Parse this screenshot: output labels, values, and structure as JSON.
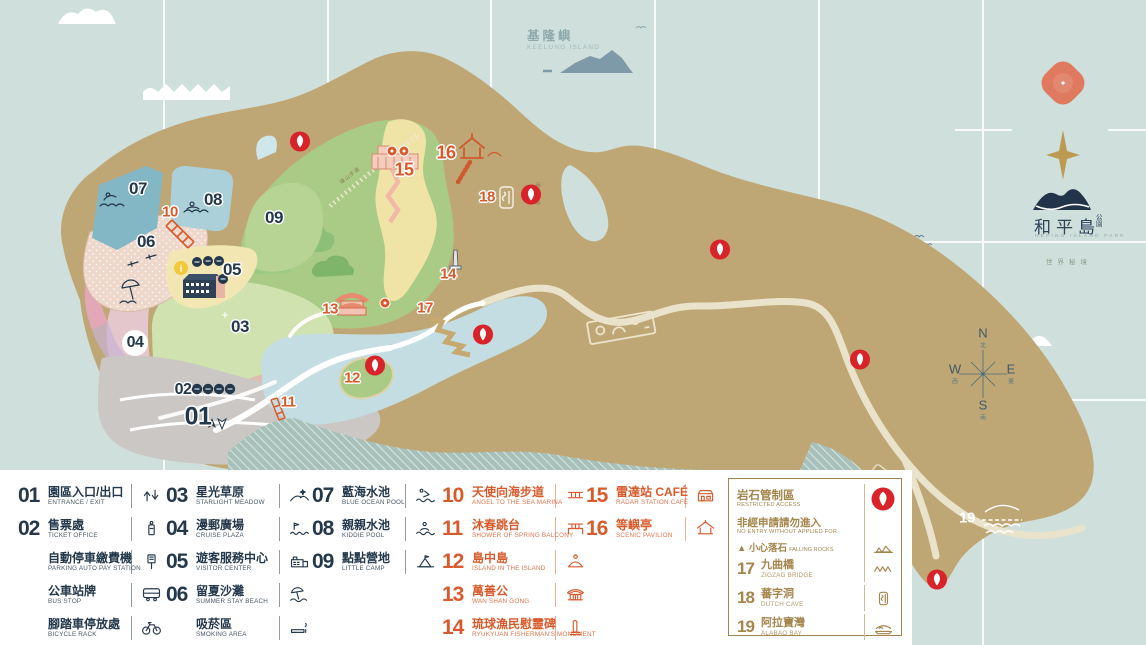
{
  "title": "和平島公園 Heping Island Park Map",
  "colors": {
    "navy": "#24384C",
    "orange": "#D95B2D",
    "gold": "#A5854C",
    "pin_red": "#D8232A",
    "sea": "#CFE0DC",
    "land": "#BFA775"
  },
  "map": {
    "keelung": {
      "cn": "基隆嶼",
      "en": "KEELUNG ISLAND"
    },
    "logo": {
      "cn_main": "和平島",
      "cn_sub": "公園",
      "en": "HEPING ISLAND PARK",
      "tagline": "世界秘境"
    },
    "compass": {
      "n": "N",
      "e": "E",
      "s": "S",
      "w": "W",
      "n_cn": "北",
      "e_cn": "東",
      "s_cn": "南",
      "w_cn": "西"
    },
    "trail_label": "環山步道",
    "markers": [
      {
        "n": "01",
        "x": 198,
        "y": 417,
        "c": "navy",
        "s": 25
      },
      {
        "n": "02",
        "x": 183,
        "y": 390,
        "c": "navy",
        "s": 16
      },
      {
        "n": "03",
        "x": 240,
        "y": 327,
        "c": "navy",
        "s": 17
      },
      {
        "n": "04",
        "x": 135,
        "y": 343,
        "c": "navy",
        "s": 16,
        "halo": true
      },
      {
        "n": "05",
        "x": 232,
        "y": 270,
        "c": "navy",
        "s": 17
      },
      {
        "n": "06",
        "x": 146,
        "y": 242,
        "c": "navy",
        "s": 17
      },
      {
        "n": "07",
        "x": 138,
        "y": 189,
        "c": "navy",
        "s": 17
      },
      {
        "n": "08",
        "x": 213,
        "y": 200,
        "c": "navy",
        "s": 17
      },
      {
        "n": "09",
        "x": 274,
        "y": 218,
        "c": "navy",
        "s": 17
      },
      {
        "n": "10",
        "x": 170,
        "y": 212,
        "c": "orange",
        "s": 15
      },
      {
        "n": "11",
        "x": 288,
        "y": 402,
        "c": "orange",
        "s": 15
      },
      {
        "n": "12",
        "x": 352,
        "y": 378,
        "c": "orange",
        "s": 15
      },
      {
        "n": "13",
        "x": 330,
        "y": 309,
        "c": "orange",
        "s": 15
      },
      {
        "n": "14",
        "x": 448,
        "y": 274,
        "c": "orange",
        "s": 15
      },
      {
        "n": "15",
        "x": 404,
        "y": 170,
        "c": "orange",
        "s": 18
      },
      {
        "n": "16",
        "x": 446,
        "y": 153,
        "c": "orange",
        "s": 18
      },
      {
        "n": "17",
        "x": 425,
        "y": 308,
        "c": "orange",
        "s": 15
      },
      {
        "n": "18",
        "x": 487,
        "y": 197,
        "c": "orange",
        "s": 15
      },
      {
        "n": "19",
        "x": 967,
        "y": 518,
        "c": "white",
        "s": 15
      }
    ],
    "pins": [
      [
        300,
        144
      ],
      [
        531,
        197
      ],
      [
        720,
        252
      ],
      [
        860,
        362
      ],
      [
        483,
        337
      ],
      [
        375,
        368
      ],
      [
        937,
        582
      ]
    ],
    "badges": [
      [
        392,
        151
      ],
      [
        404,
        151
      ],
      [
        385,
        303
      ]
    ]
  },
  "legend": {
    "columns": [
      {
        "color": "navy",
        "items": [
          {
            "num": "01",
            "cn": "園區入口/出口",
            "en": "ENTRANCE / EXIT",
            "icon": "entrance"
          },
          {
            "num": "02",
            "cn": "售票處",
            "en": "TICKET OFFICE",
            "icon": "ticket"
          },
          {
            "num": "",
            "cn": "自動停車繳費機",
            "en": "PARKING AUTO PAY STATION",
            "icon": "paystation"
          },
          {
            "num": "",
            "cn": "公車站牌",
            "en": "BUS STOP",
            "icon": "bus"
          },
          {
            "num": "",
            "cn": "腳踏車停放處",
            "en": "BICYCLE RACK",
            "icon": "bicycle"
          }
        ]
      },
      {
        "color": "navy",
        "items": [
          {
            "num": "03",
            "cn": "星光草原",
            "en": "STARLIGHT MEADOW",
            "icon": "meadow"
          },
          {
            "num": "04",
            "cn": "漫郵廣場",
            "en": "CRUISE PLAZA",
            "icon": "plaza"
          },
          {
            "num": "05",
            "cn": "遊客服務中心",
            "en": "VISITOR CENTER",
            "icon": "visitor"
          },
          {
            "num": "06",
            "cn": "留夏沙灘",
            "en": "SUMMER STAY BEACH",
            "icon": "beach"
          },
          {
            "num": "",
            "cn": "吸菸區",
            "en": "SMOKING AREA",
            "icon": "smoking"
          }
        ]
      },
      {
        "color": "navy",
        "items": [
          {
            "num": "07",
            "cn": "藍海水池",
            "en": "BLUE OCEAN POOL",
            "icon": "pool"
          },
          {
            "num": "08",
            "cn": "親親水池",
            "en": "KIDDIE POOL",
            "icon": "kiddie"
          },
          {
            "num": "09",
            "cn": "點點營地",
            "en": "LITTLE CAMP",
            "icon": "camp"
          }
        ]
      },
      {
        "color": "orange",
        "items": [
          {
            "num": "10",
            "cn": "天使向海步道",
            "en": "ANGEL TO THE SEA MARINA",
            "icon": "walk"
          },
          {
            "num": "11",
            "cn": "沐春跳台",
            "en": "SHOWER OF SPRING BALCONY",
            "icon": "balcony"
          },
          {
            "num": "12",
            "cn": "島中島",
            "en": "ISLAND IN THE ISLAND",
            "icon": "island"
          },
          {
            "num": "13",
            "cn": "萬善公",
            "en": "WAN SHAN GONG",
            "icon": "temple"
          },
          {
            "num": "14",
            "cn": "琉球漁民慰靈碑",
            "en": "RYUKYUAN FISHERMAN'S MONUMENT",
            "icon": "monument"
          }
        ]
      },
      {
        "color": "orange",
        "items": [
          {
            "num": "15",
            "cn": "雷達站 CAFÉ",
            "en": "RADAR STATION CAFÉ",
            "icon": "cafe"
          },
          {
            "num": "16",
            "cn": "等嶼亭",
            "en": "SCENIC PAVILION",
            "icon": "pavilion"
          }
        ]
      }
    ],
    "restricted": {
      "title_cn": "岩石管制區",
      "title_en": "RESTRICTED ACCESS",
      "subtitle_cn": "非經申請請勿進入",
      "subtitle_en": "NO ENTRY WITHOUT APPLIED FOR",
      "warning_mark": "▲",
      "warning_cn": "小心落石",
      "warning_en": "FALLING ROCKS",
      "items": [
        {
          "num": "17",
          "cn": "九曲橋",
          "en": "ZIGZAG BRIDGE",
          "icon": "zigzag"
        },
        {
          "num": "18",
          "cn": "蕃字洞",
          "en": "DUTCH CAVE",
          "icon": "cave"
        },
        {
          "num": "19",
          "cn": "阿拉寶灣",
          "en": "ALABAO BAY",
          "icon": "bay"
        }
      ]
    }
  }
}
